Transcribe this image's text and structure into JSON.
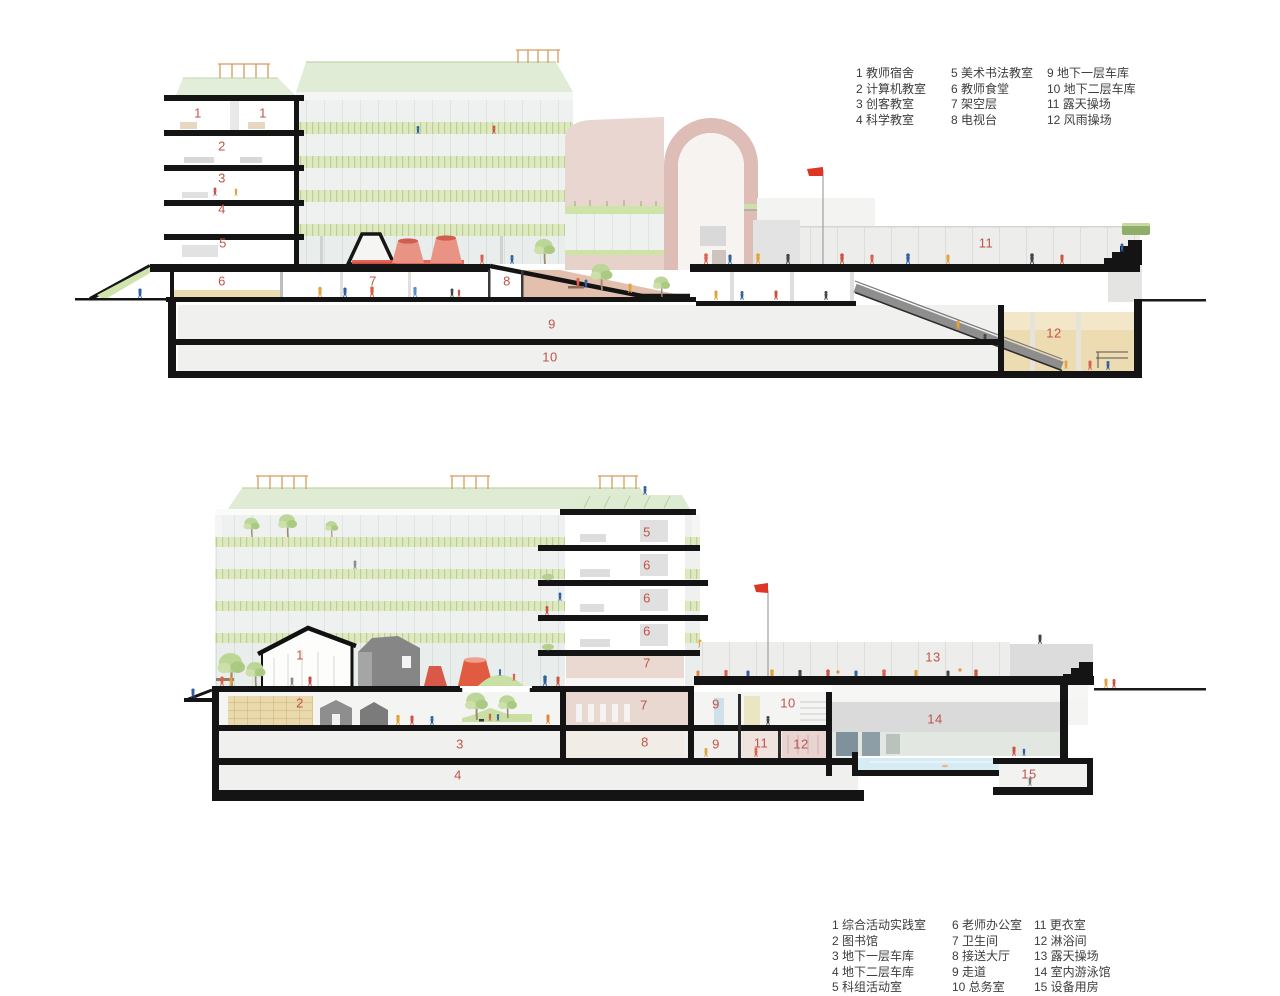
{
  "document": {
    "type": "architectural-section-drawings",
    "background": "#ffffff"
  },
  "colors": {
    "marker_red": "#bf5449",
    "legend_text": "#3d3d3d",
    "section_cut_black": "#141414",
    "railing_green": "#dfe9c1",
    "roof_glass_green": "#e0ecd6",
    "orange_frame": "#d89a5e",
    "arch_pink": "#ead6d0",
    "flag_red": "#dd3526",
    "play_red": "#e2574a",
    "sand_floor": "#eddbb2",
    "pool_water": "#d6ebf3",
    "tree_green": "#bcd697"
  },
  "section_top": {
    "legend": {
      "columns": [
        {
          "items": [
            {
              "n": "1",
              "label": "教师宿舍"
            },
            {
              "n": "2",
              "label": "计算机教室"
            },
            {
              "n": "3",
              "label": "创客教室"
            },
            {
              "n": "4",
              "label": "科学教室"
            }
          ]
        },
        {
          "items": [
            {
              "n": "5",
              "label": "美术书法教室"
            },
            {
              "n": "6",
              "label": "教师食堂"
            },
            {
              "n": "7",
              "label": "架空层"
            },
            {
              "n": "8",
              "label": "电视台"
            }
          ]
        },
        {
          "items": [
            {
              "n": "9",
              "label": "地下一层车库"
            },
            {
              "n": "10",
              "label": "地下二层车库"
            },
            {
              "n": "11",
              "label": "露天操场"
            },
            {
              "n": "12",
              "label": "风雨操场"
            }
          ]
        }
      ]
    },
    "markers": [
      {
        "t": "1",
        "x": 198,
        "y": 113
      },
      {
        "t": "1",
        "x": 263,
        "y": 113
      },
      {
        "t": "2",
        "x": 222,
        "y": 146
      },
      {
        "t": "3",
        "x": 222,
        "y": 178
      },
      {
        "t": "4",
        "x": 222,
        "y": 209
      },
      {
        "t": "5",
        "x": 223,
        "y": 243
      },
      {
        "t": "6",
        "x": 222,
        "y": 281
      },
      {
        "t": "7",
        "x": 373,
        "y": 281
      },
      {
        "t": "8",
        "x": 507,
        "y": 281
      },
      {
        "t": "9",
        "x": 552,
        "y": 324
      },
      {
        "t": "10",
        "x": 550,
        "y": 357
      },
      {
        "t": "11",
        "x": 986,
        "y": 243
      },
      {
        "t": "12",
        "x": 1054,
        "y": 333
      }
    ]
  },
  "section_bottom": {
    "legend": {
      "columns": [
        {
          "items": [
            {
              "n": "1",
              "label": "综合活动实践室"
            },
            {
              "n": "2",
              "label": "图书馆"
            },
            {
              "n": "3",
              "label": "地下一层车库"
            },
            {
              "n": "4",
              "label": "地下二层车库"
            },
            {
              "n": "5",
              "label": "科组活动室"
            }
          ]
        },
        {
          "items": [
            {
              "n": "6",
              "label": "老师办公室"
            },
            {
              "n": "7",
              "label": "卫生间"
            },
            {
              "n": "8",
              "label": "接送大厅"
            },
            {
              "n": "9",
              "label": "走道"
            },
            {
              "n": "10",
              "label": "总务室"
            }
          ]
        },
        {
          "items": [
            {
              "n": "11",
              "label": "更衣室"
            },
            {
              "n": "12",
              "label": "淋浴间"
            },
            {
              "n": "13",
              "label": "露天操场"
            },
            {
              "n": "14",
              "label": "室内游泳馆"
            },
            {
              "n": "15",
              "label": "设备用房"
            }
          ]
        }
      ]
    },
    "markers": [
      {
        "t": "1",
        "x": 300,
        "y": 225
      },
      {
        "t": "2",
        "x": 300,
        "y": 273
      },
      {
        "t": "3",
        "x": 460,
        "y": 314
      },
      {
        "t": "4",
        "x": 458,
        "y": 345
      },
      {
        "t": "5",
        "x": 647,
        "y": 102
      },
      {
        "t": "6",
        "x": 647,
        "y": 135
      },
      {
        "t": "6",
        "x": 647,
        "y": 168
      },
      {
        "t": "6",
        "x": 647,
        "y": 201
      },
      {
        "t": "7",
        "x": 647,
        "y": 233
      },
      {
        "t": "7",
        "x": 644,
        "y": 275
      },
      {
        "t": "8",
        "x": 645,
        "y": 312
      },
      {
        "t": "9",
        "x": 716,
        "y": 274
      },
      {
        "t": "9",
        "x": 716,
        "y": 314
      },
      {
        "t": "10",
        "x": 788,
        "y": 273
      },
      {
        "t": "11",
        "x": 761,
        "y": 313
      },
      {
        "t": "12",
        "x": 801,
        "y": 314
      },
      {
        "t": "13",
        "x": 933,
        "y": 227
      },
      {
        "t": "14",
        "x": 935,
        "y": 289
      },
      {
        "t": "15",
        "x": 1029,
        "y": 344
      }
    ]
  }
}
